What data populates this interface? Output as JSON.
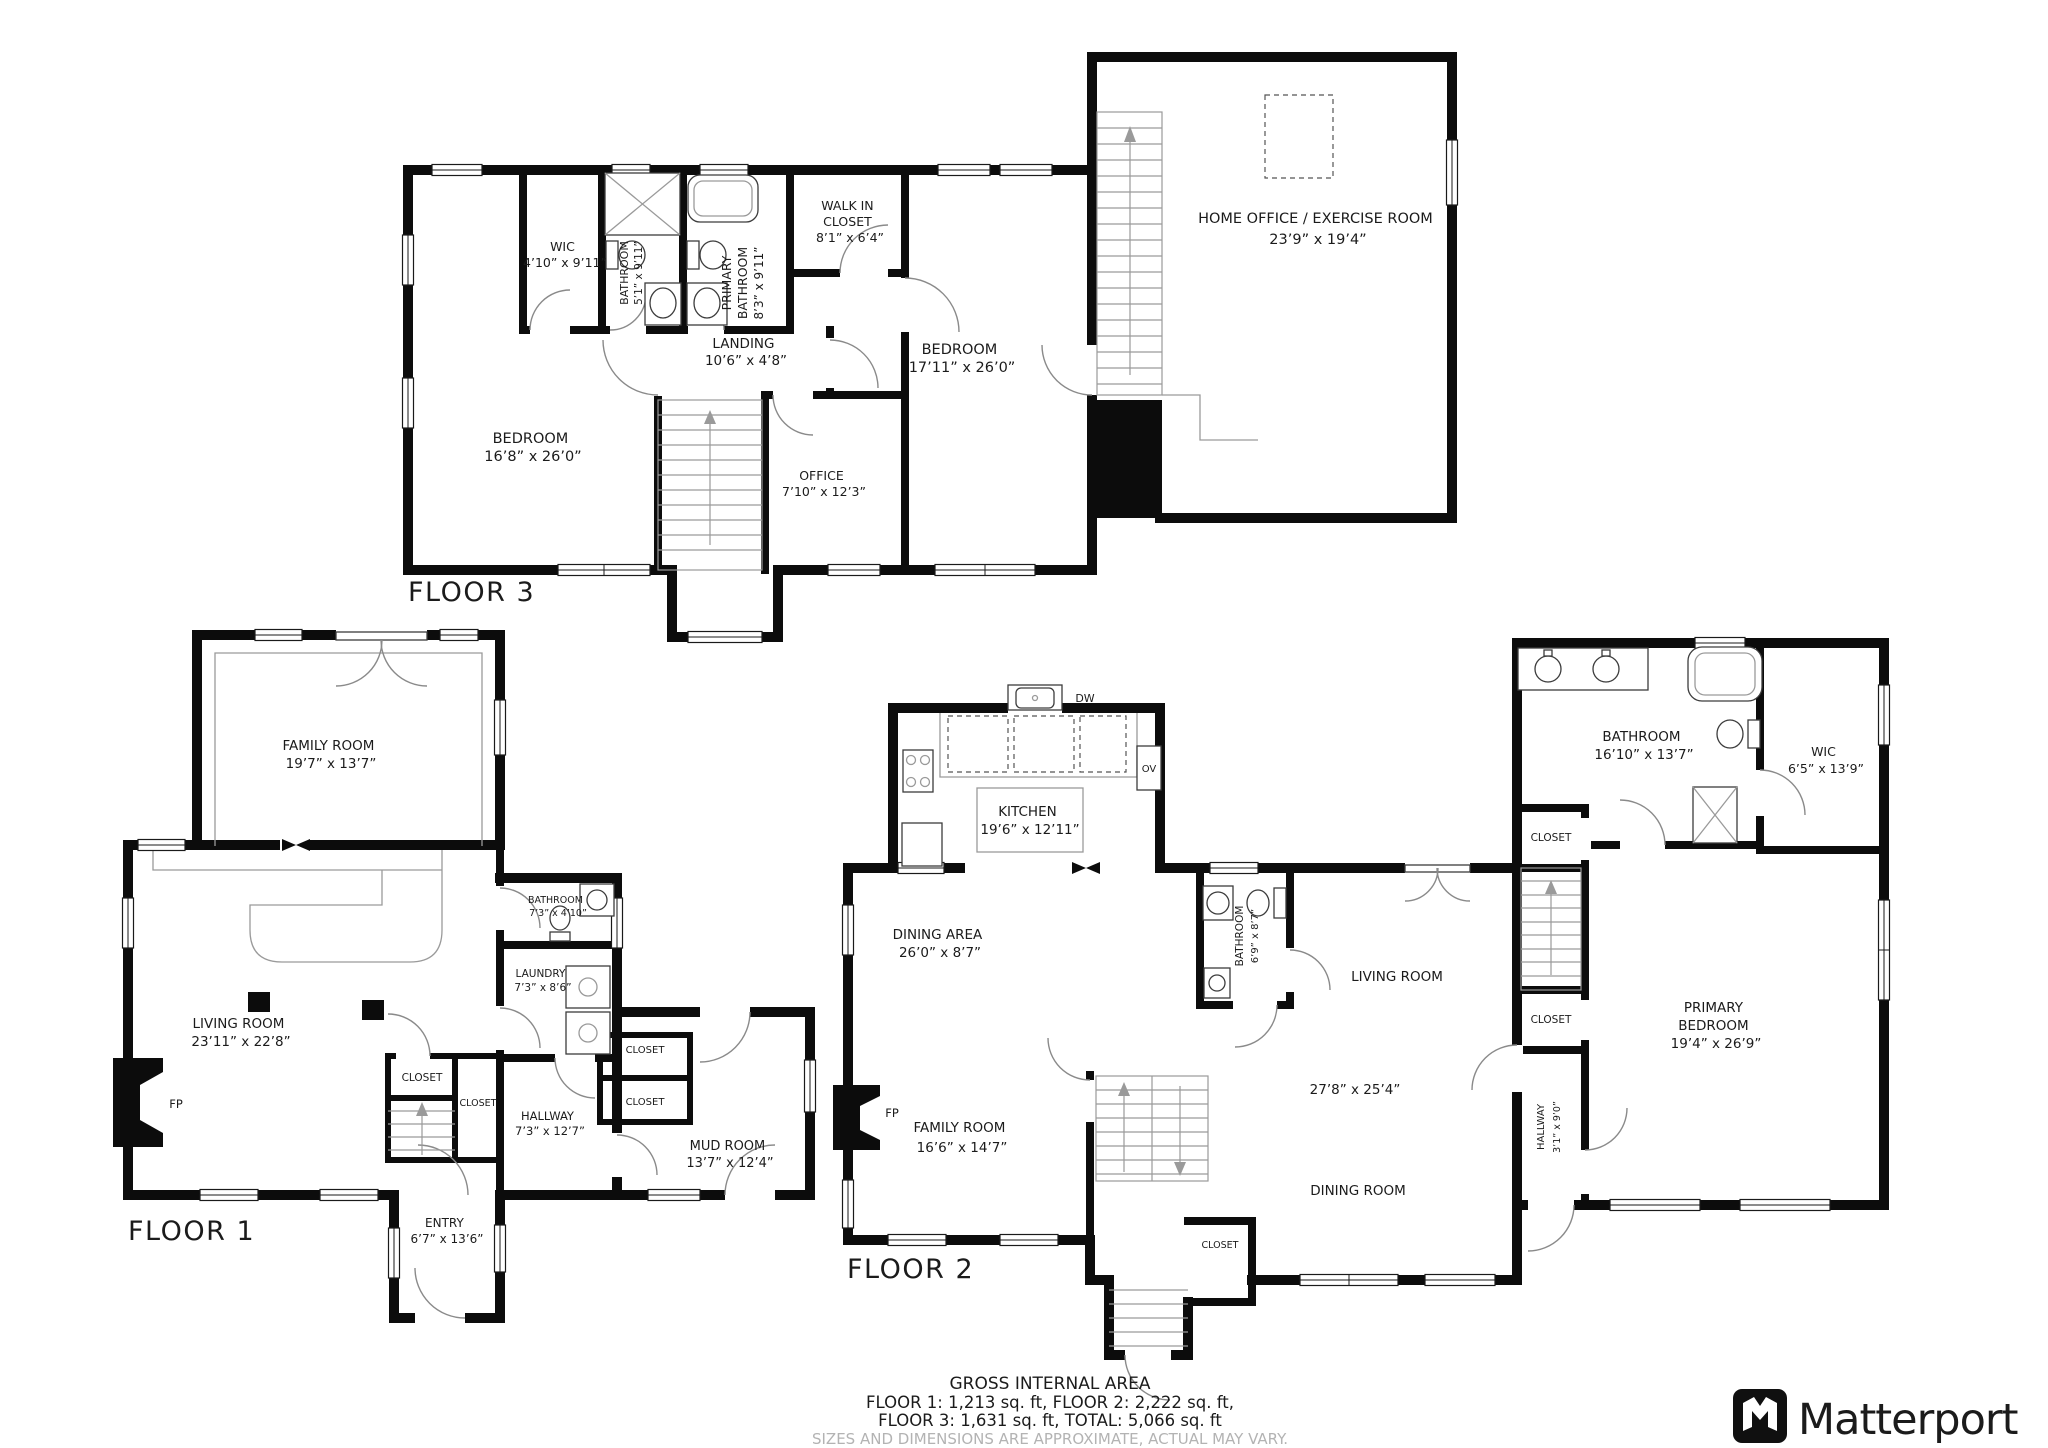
{
  "floor3": {
    "title": "FLOOR 3",
    "bedroom_left": {
      "name": "BEDROOM",
      "dims": "16’8” x 26’0”"
    },
    "wic": {
      "name": "WIC",
      "dims": "4’10” x 9’11”"
    },
    "bathroom": {
      "name": "BATHROOM",
      "dims": "5’1” x 9’11”"
    },
    "primary_bathroom": {
      "line1": "PRIMARY",
      "line2": "BATHROOM",
      "dims": "8’3” x 9’11”"
    },
    "walk_in_closet": {
      "line1": "WALK IN",
      "line2": "CLOSET",
      "dims": "8’1” x 6’4”"
    },
    "bedroom_right": {
      "name": "BEDROOM",
      "dims": "17’11” x 26’0”"
    },
    "landing": {
      "name": "LANDING",
      "dims": "10’6” x 4’8”"
    },
    "office": {
      "name": "OFFICE",
      "dims": "7’10” x 12’3”"
    },
    "home_office": {
      "name": "HOME OFFICE / EXERCISE ROOM",
      "dims": "23’9” x 19’4”"
    }
  },
  "floor1": {
    "title": "FLOOR 1",
    "family_room": {
      "name": "FAMILY ROOM",
      "dims": "19’7” x 13’7”"
    },
    "living_room": {
      "name": "LIVING ROOM",
      "dims": "23’11” x 22’8”"
    },
    "fireplace": "FP",
    "bathroom": {
      "name": "BATHROOM",
      "dims": "7’3” x 4’10”"
    },
    "laundry": {
      "name": "LAUNDRY",
      "dims": "7’3” x 8’6”"
    },
    "closet_a": "CLOSET",
    "closet_b": "CLOSET",
    "hallway": {
      "name": "HALLWAY",
      "dims": "7’3” x 12’7”"
    },
    "mud_closet_a": "CLOSET",
    "mud_closet_b": "CLOSET",
    "mud_room": {
      "name": "MUD ROOM",
      "dims": "13’7” x 12’4”"
    },
    "entry": {
      "name": "ENTRY",
      "dims": "6’7” x 13’6”"
    }
  },
  "floor2": {
    "title": "FLOOR 2",
    "dishwasher": "DW",
    "oven": "OV",
    "kitchen": {
      "name": "KITCHEN",
      "dims": "19’6” x 12’11”"
    },
    "dining_area": {
      "name": "DINING AREA",
      "dims": "26’0” x 8’7”"
    },
    "bathroom": {
      "name": "BATHROOM",
      "dims": "6’9” x 8’7”"
    },
    "living_room": "LIVING ROOM",
    "great_room_dims": "27’8” x 25’4”",
    "dining_room": "DINING ROOM",
    "family_room": {
      "name": "FAMILY ROOM",
      "dims": "16’6” x 14’7”"
    },
    "fireplace": "FP",
    "closet": "CLOSET",
    "suite_bathroom": {
      "name": "BATHROOM",
      "dims": "16’10” x 13’7”"
    },
    "suite_wic": {
      "name": "WIC",
      "dims": "6’5” x 13’9”"
    },
    "suite_closet_a": "CLOSET",
    "suite_closet_b": "CLOSET",
    "suite_hallway": {
      "name": "HALLWAY",
      "dims": "3’1” x 9’0”"
    },
    "primary_bedroom": {
      "line1": "PRIMARY",
      "line2": "BEDROOM",
      "dims": "19’4” x 26’9”"
    }
  },
  "footer": {
    "title": "GROSS INTERNAL AREA",
    "line1": "FLOOR 1: 1,213 sq. ft, FLOOR 2: 2,222 sq. ft,",
    "line2": "FLOOR 3: 1,631 sq. ft, TOTAL: 5,066 sq. ft",
    "disclaimer": "SIZES AND DIMENSIONS ARE APPROXIMATE, ACTUAL MAY VARY."
  },
  "brand": {
    "name": "Matterport"
  }
}
